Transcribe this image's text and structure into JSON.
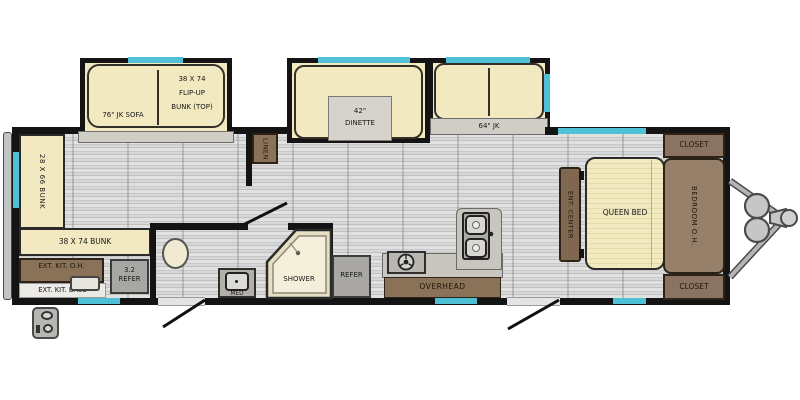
{
  "floorplan": {
    "type": "travel-trailer-floorplan",
    "labels": {
      "sofa76": "76\" JK SOFA",
      "flipup_line1": "38 X 74",
      "flipup_line2": "FLIP-UP",
      "flipup_line3": "BUNK (TOP)",
      "dinette_line1": "42\"",
      "dinette_line2": "DINETTE",
      "sofa64": "64\" JK",
      "linen": "LINEN",
      "bunk_vertical": "28 X 66 BUNK",
      "bunk_horizontal": "38 X 74 BUNK",
      "ext_kit_oh": "EXT. KIT. O.H.",
      "ext_kit_base": "EXT. KIT. BASE",
      "refer_small_line1": "3.2",
      "refer_small_line2": "REFER",
      "med": "MED",
      "shower": "SHOWER",
      "refer_main": "REFER",
      "overhead": "OVERHEAD",
      "ent_center": "ENT. CENTER",
      "queen_bed": "QUEEN BED",
      "bedroom_oh": "BEDROOM O.H.",
      "closet_top": "CLOSET",
      "closet_bottom": "CLOSET"
    },
    "colors": {
      "wall": "#141414",
      "window": "#4fc0d6",
      "furniture_cream": "#f2e9c0",
      "cabinet_brown": "#8a7259",
      "bedroom_oh_brown": "#97806a",
      "appliance_gray": "#a9a7a3",
      "counter_gray": "#c9c6c0",
      "floor_gray": "#d5d5d5"
    }
  }
}
